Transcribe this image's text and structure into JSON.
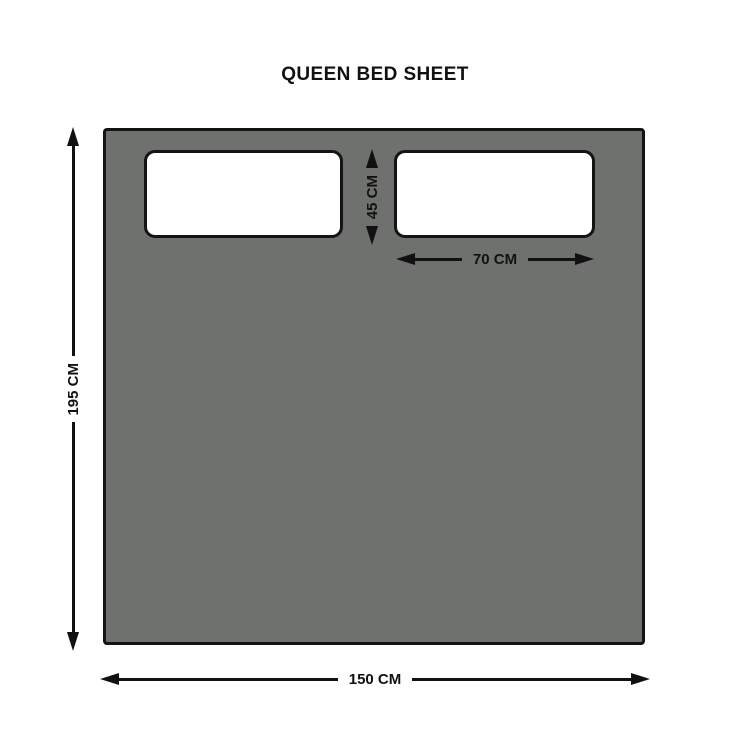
{
  "title": "QUEEN BED SHEET",
  "dimensions": {
    "sheet_height": "195 CM",
    "sheet_width": "150 CM",
    "pillow_height": "45 CM",
    "pillow_width": "70 CM"
  },
  "colors": {
    "sheet_fill": "#6f716e",
    "pillow_fill": "#ffffff",
    "outline": "#141414",
    "text": "#111111",
    "background": "#ffffff"
  }
}
